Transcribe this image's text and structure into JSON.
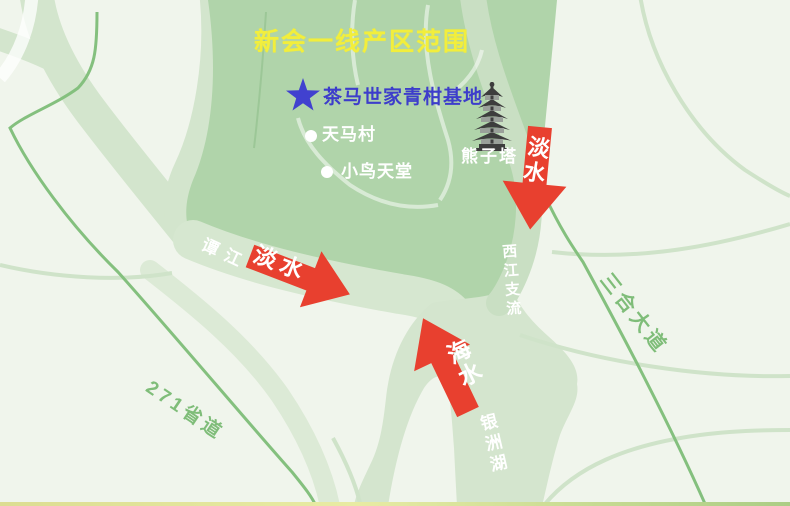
{
  "map": {
    "title": "新会一线产区范围",
    "base": {
      "label": "茶马世家青柑基地"
    },
    "places": {
      "tianma_village": "天马村",
      "bird_paradise": "小鸟天堂",
      "pagoda": "熊子塔"
    },
    "waterways": {
      "tanjiang": "谭江",
      "xijiang_branch": "西江支流",
      "yinzhou_lake": "银洲湖"
    },
    "roads": {
      "sanhe_avenue": "三合大道",
      "provincial_271": "271省道"
    },
    "flow_arrows": [
      {
        "label": "淡水",
        "direction": "down-from-north"
      },
      {
        "label": "淡水",
        "direction": "southeast-from-west"
      },
      {
        "label": "海水",
        "direction": "northwest-from-sea"
      }
    ],
    "colors": {
      "background": "#f0f5ec",
      "core_region": "#b0d4aa",
      "river": "#d6e7d0",
      "river_branch": "#c9dfc3",
      "road_line": "#84c07e",
      "road_label": "#7fbd79",
      "arrow_red": "#e8402f",
      "title_yellow": "#f2ee3c",
      "base_blue": "#3d3dcb",
      "label_white": "#ffffff"
    }
  }
}
